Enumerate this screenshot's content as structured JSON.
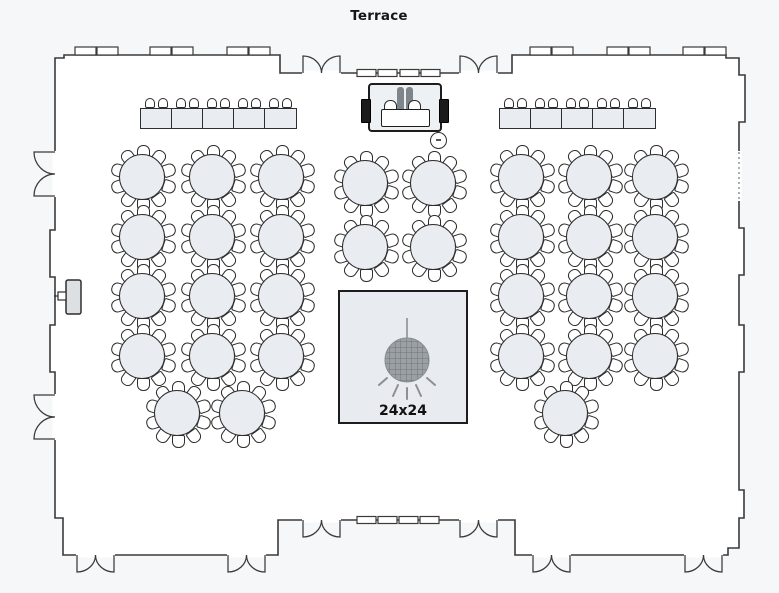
{
  "title": {
    "text": "Terrace"
  },
  "colors": {
    "background": "#f6f7f8",
    "room_fill": "#ffffff",
    "wall": "#3a3a3a",
    "table_fill": "#e9edf1",
    "chair_fill": "#ffffff",
    "stage_fill": "#eef1f3",
    "dance_floor_fill": "#e8ecf0",
    "disco_ball": "#9aa0a4"
  },
  "round_tables": {
    "seats_per_table": 10,
    "diameter": 46,
    "positions": [
      [
        142,
        177
      ],
      [
        212,
        177
      ],
      [
        281,
        177
      ],
      [
        142,
        237
      ],
      [
        212,
        237
      ],
      [
        281,
        237
      ],
      [
        142,
        296
      ],
      [
        212,
        296
      ],
      [
        281,
        296
      ],
      [
        142,
        356
      ],
      [
        212,
        356
      ],
      [
        281,
        356
      ],
      [
        177,
        413
      ],
      [
        242,
        413
      ],
      [
        365,
        183
      ],
      [
        433,
        183
      ],
      [
        365,
        247
      ],
      [
        433,
        247
      ],
      [
        521,
        177
      ],
      [
        589,
        177
      ],
      [
        655,
        177
      ],
      [
        521,
        237
      ],
      [
        589,
        237
      ],
      [
        655,
        237
      ],
      [
        521,
        296
      ],
      [
        589,
        296
      ],
      [
        655,
        296
      ],
      [
        521,
        356
      ],
      [
        589,
        356
      ],
      [
        655,
        356
      ],
      [
        565,
        413
      ]
    ]
  },
  "banquet_rows": [
    {
      "side": "left",
      "x": 140,
      "y": 108,
      "tables": 5,
      "step": 31,
      "chairs_per_table": 2
    },
    {
      "side": "right",
      "x": 499,
      "y": 108,
      "tables": 5,
      "step": 31,
      "chairs_per_table": 2
    }
  ],
  "head_table_stage": {
    "x": 368,
    "y": 83,
    "width": 74,
    "height": 49
  },
  "cocktail_table": {
    "x": 438,
    "y": 140,
    "diameter": 17
  },
  "dance_floor": {
    "x": 338,
    "y": 290,
    "width": 130,
    "height": 134,
    "label": "24x24"
  }
}
